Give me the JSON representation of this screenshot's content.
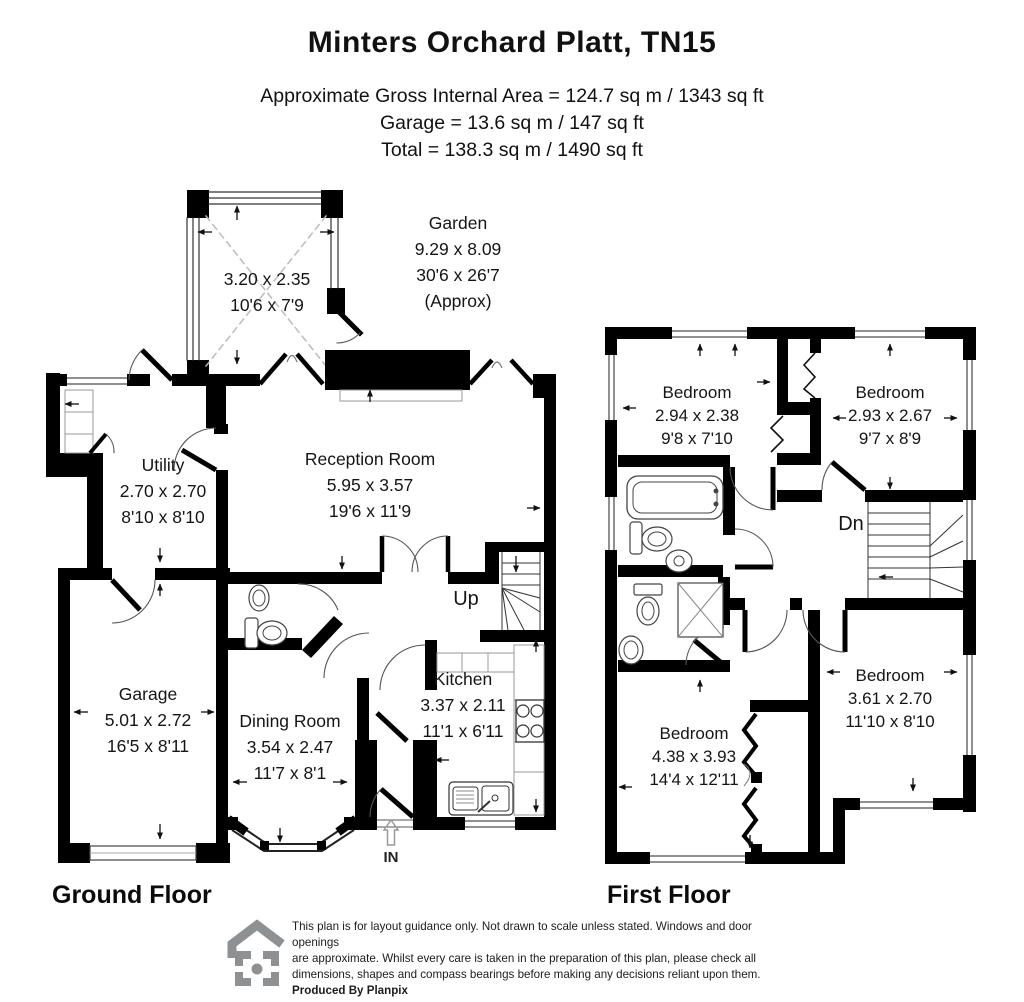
{
  "header": {
    "title": "Minters Orchard Platt, TN15",
    "area_line1": "Approximate Gross Internal Area = 124.7 sq m / 1343 sq ft",
    "area_line2": "Garage = 13.6 sq m / 147 sq ft",
    "area_line3": "Total = 138.3 sq m / 1490 sq ft"
  },
  "ground_floor": {
    "label": "Ground Floor",
    "garden": {
      "name": "Garden",
      "metric": "9.29 x 8.09",
      "imperial": "30'6 x 26'7",
      "approx": "(Approx)"
    },
    "conservatory": {
      "metric": "3.20 x 2.35",
      "imperial": "10'6 x 7'9"
    },
    "rooms": [
      {
        "name": "Utility",
        "metric": "2.70 x 2.70",
        "imperial": "8'10 x 8'10"
      },
      {
        "name": "Reception Room",
        "metric": "5.95 x 3.57",
        "imperial": "19'6 x 11'9"
      },
      {
        "name": "Garage",
        "metric": "5.01 x 2.72",
        "imperial": "16'5 x 8'11"
      },
      {
        "name": "Dining Room",
        "metric": "3.54 x 2.47",
        "imperial": "11'7 x 8'1"
      },
      {
        "name": "Kitchen",
        "metric": "3.37 x 2.11",
        "imperial": "11'1 x 6'11"
      }
    ],
    "stairs_label": "Up",
    "entrance_label": "IN"
  },
  "first_floor": {
    "label": "First Floor",
    "rooms": [
      {
        "name": "Bedroom",
        "metric": "2.94 x 2.38",
        "imperial": "9'8 x 7'10"
      },
      {
        "name": "Bedroom",
        "metric": "2.93 x 2.67",
        "imperial": "9'7 x 8'9"
      },
      {
        "name": "Bedroom",
        "metric": "4.38 x 3.93",
        "imperial": "14'4 x 12'11"
      },
      {
        "name": "Bedroom",
        "metric": "3.61 x 2.70",
        "imperial": "11'10 x 8'10"
      }
    ],
    "stairs_label": "Dn"
  },
  "footer": {
    "lines": [
      "This plan is for layout guidance only. Not drawn to scale unless stated. Windows and door openings",
      "are approximate. Whilst every care is taken in the preparation of this plan, please check all",
      "dimensions, shapes and compass bearings before making any decisions reliant upon them.",
      "Produced By Planpix"
    ]
  },
  "colors": {
    "wall": "#000000",
    "text": "#111111",
    "fixture": "#555555",
    "logo_gray": "#8d9193"
  }
}
